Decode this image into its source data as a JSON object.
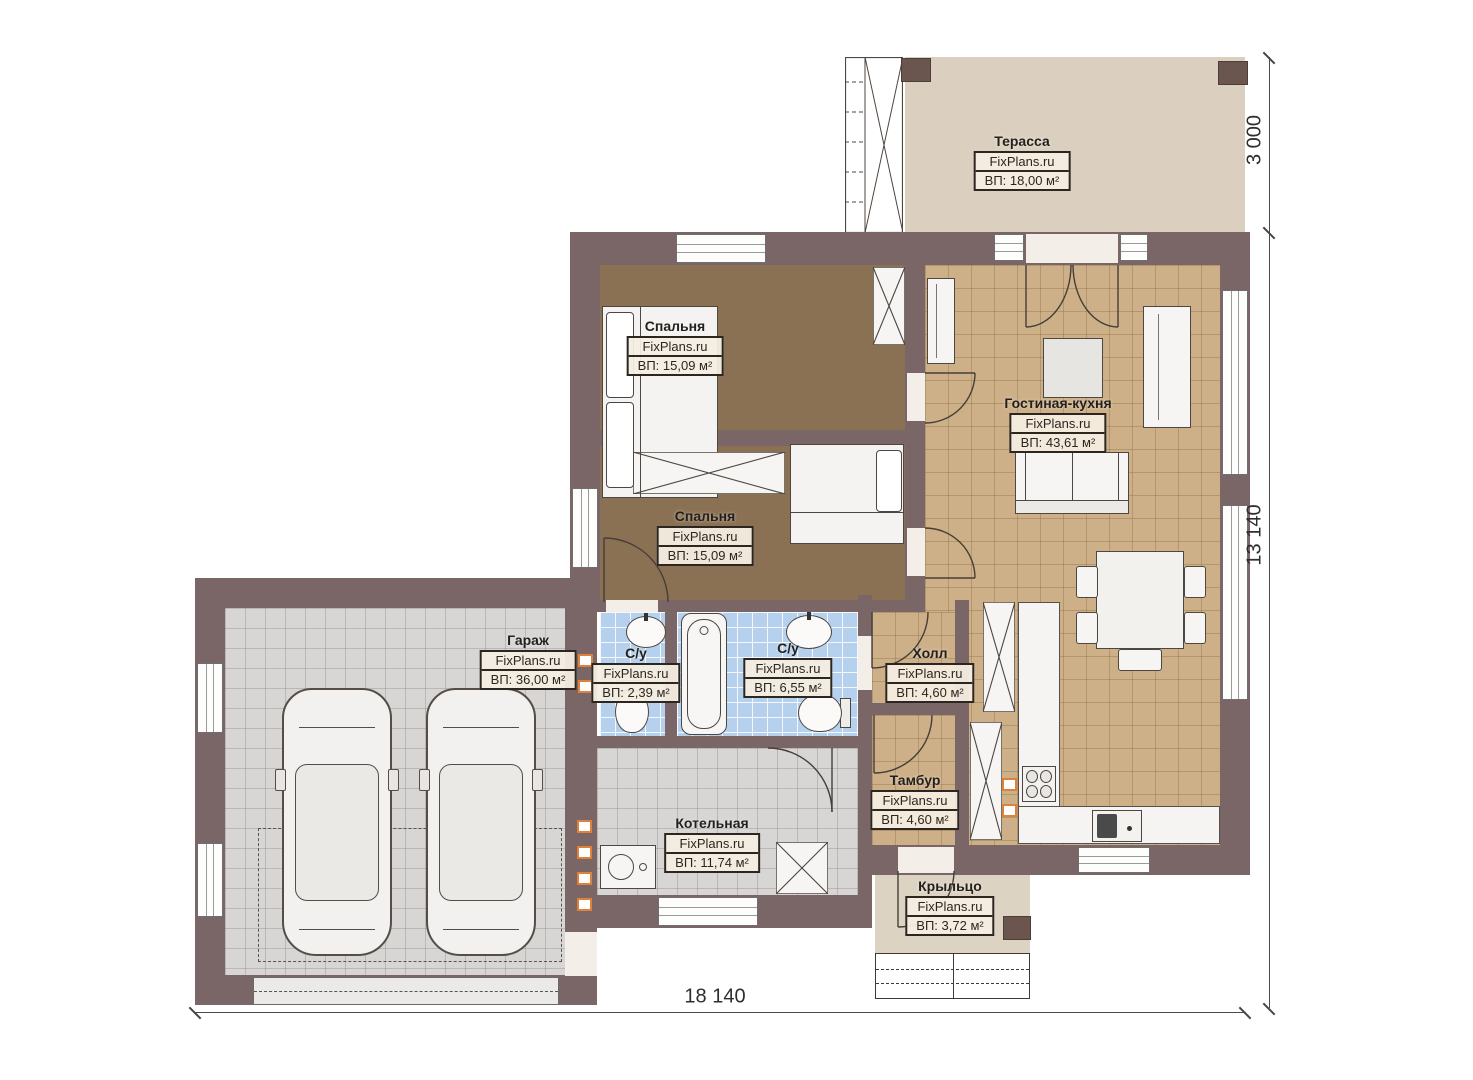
{
  "plan": {
    "brand": "FixPlans.ru",
    "dimensions": {
      "bottom": "18 140",
      "right": "13 140",
      "terrace_depth": "3 000"
    },
    "rooms": [
      {
        "id": "terrace",
        "name": "Терасса",
        "watermark": "FixPlans.ru",
        "area": "ВП: 18,00 м²"
      },
      {
        "id": "bedroom-1",
        "name": "Спальня",
        "watermark": "FixPlans.ru",
        "area": "ВП: 15,09 м²"
      },
      {
        "id": "bedroom-2",
        "name": "Спальня",
        "watermark": "FixPlans.ru",
        "area": "ВП: 15,09 м²"
      },
      {
        "id": "living-kitchen",
        "name": "Гостиная-кухня",
        "watermark": "FixPlans.ru",
        "area": "ВП: 43,61 м²"
      },
      {
        "id": "garage",
        "name": "Гараж",
        "watermark": "FixPlans.ru",
        "area": "ВП: 36,00 м²"
      },
      {
        "id": "wc-small",
        "name": "С/у",
        "watermark": "FixPlans.ru",
        "area": "ВП: 2,39 м²"
      },
      {
        "id": "wc-large",
        "name": "С/у",
        "watermark": "FixPlans.ru",
        "area": "ВП: 6,55 м²"
      },
      {
        "id": "hall",
        "name": "Холл",
        "watermark": "FixPlans.ru",
        "area": "ВП: 4,60 м²"
      },
      {
        "id": "vestibule",
        "name": "Тамбур",
        "watermark": "FixPlans.ru",
        "area": "ВП: 4,60 м²"
      },
      {
        "id": "boiler",
        "name": "Котельная",
        "watermark": "FixPlans.ru",
        "area": "ВП: 11,74 м²"
      },
      {
        "id": "porch",
        "name": "Крыльцо",
        "watermark": "FixPlans.ru",
        "area": "ВП: 3,72 м²"
      }
    ],
    "colors": {
      "wall": "#7a6567",
      "floor_bedroom": "#8a7153",
      "floor_living": "#cdb088",
      "floor_garage": "#d7d6d4",
      "floor_bath": "#b5d1ed",
      "floor_terrace": "#dbd0bf",
      "vent_accent": "#e0813a",
      "label_border": "#2d2620"
    }
  }
}
